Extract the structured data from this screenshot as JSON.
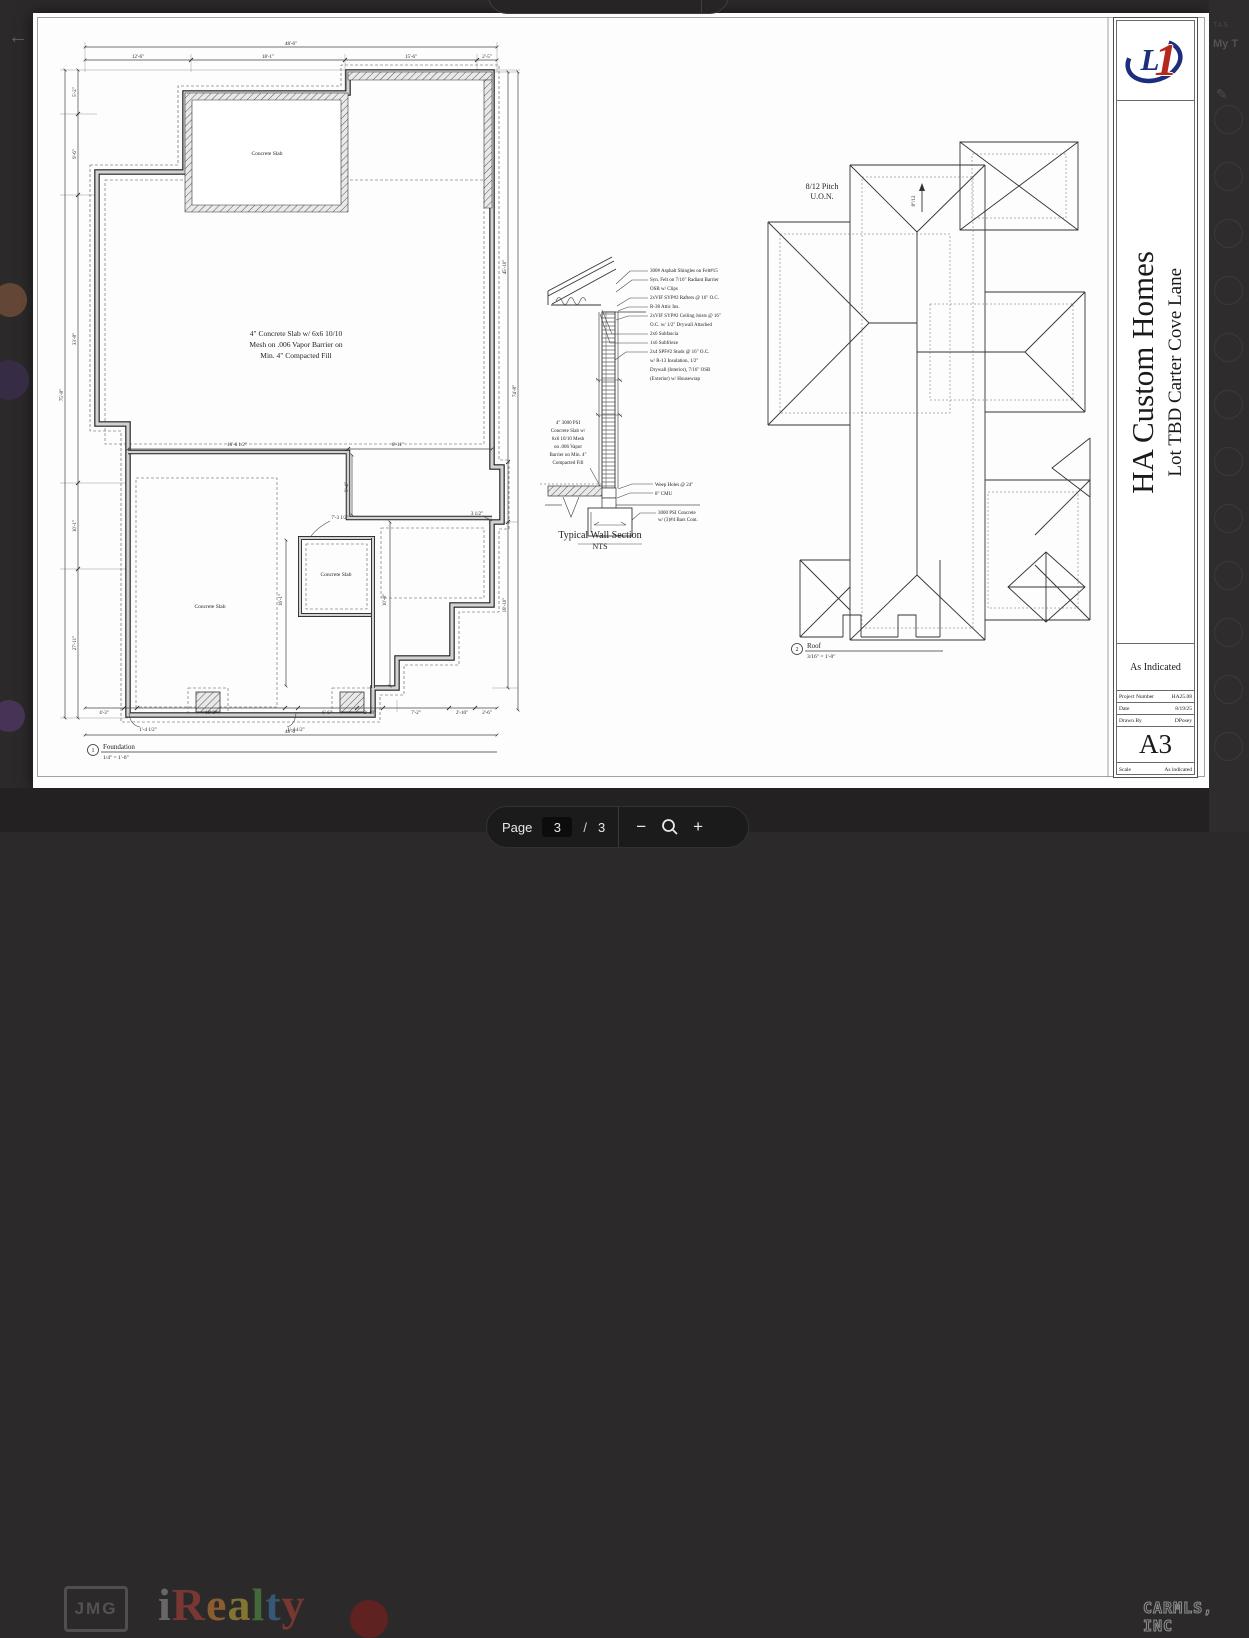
{
  "viewer": {
    "back_icon": "←",
    "bottom_toolbar": {
      "page_label": "Page",
      "current_page": "3",
      "separator": "/",
      "total_pages": "3",
      "zoom_out_icon": "−",
      "zoom_in_icon": "+"
    },
    "right_sidebar": {
      "text_top": "TAS",
      "text_bold": "My T",
      "edit_icon": "✎"
    },
    "background": {
      "jmg_logo": "JMG",
      "irealty_letters": [
        {
          "ch": "i",
          "color": "#9a9a9a"
        },
        {
          "ch": "R",
          "color": "#b8433a"
        },
        {
          "ch": "e",
          "color": "#d98836"
        },
        {
          "ch": "a",
          "color": "#c9b33b"
        },
        {
          "ch": "l",
          "color": "#5a9e4a"
        },
        {
          "ch": "t",
          "color": "#3f7fb5"
        },
        {
          "ch": "y",
          "color": "#b8433a"
        }
      ],
      "watermark": "CARMLS, INC"
    }
  },
  "sheet": {
    "title_block": {
      "logo_l": "L",
      "logo_1": "1",
      "company": "HA Custom Homes",
      "project": "Lot TBD Carter Cove Lane",
      "scale_header": "As Indicated",
      "rows": [
        {
          "label": "Project Number",
          "value": "HA25.08"
        },
        {
          "label": "Date",
          "value": "8/19/25"
        },
        {
          "label": "Drawn By",
          "value": "DPosey"
        }
      ],
      "sheet_number": "A3",
      "scale_label": "Scale",
      "scale_value": "As indicated"
    },
    "foundation": {
      "center_note": [
        "4\" Concrete Slab w/ 6x6 10/10",
        "Mesh on .006 Vapor Barrier on",
        "Min. 4\" Compacted Fill"
      ],
      "slab_labels": [
        "Concrete Slab",
        "Concrete Slab",
        "Concrete Slab"
      ],
      "dims": {
        "top_total": "48'-6\"",
        "top": [
          "12'-6\"",
          "18'-1\"",
          "15'-6\"",
          "2'-5\""
        ],
        "left_total": "75'-8\"",
        "left": [
          "5'-2\"",
          "9'-6\"",
          "33'-8\"",
          "10'-1\"",
          "27'-11\""
        ],
        "right": [
          "45'-10\"",
          "74'-8\"",
          "18'-10\""
        ],
        "bottom": [
          "4'-3\"",
          "16'-3\"",
          "6'-6\"",
          "2'-10\"",
          "7'-2\"",
          "2'-10\"",
          "2'-6\""
        ],
        "bottom_total": "48'-6\"",
        "bottom_leaders": [
          "1'-4 1/2\"",
          "1'-4 1/2\""
        ],
        "mid": [
          "16'-6 1/2\"",
          "8'-11\"",
          "9'-4\"",
          "7'-3 1/2\"",
          "3 1/2\"",
          "16'-1\"",
          "10'-8\""
        ]
      },
      "caption": {
        "num": "1",
        "title": "Foundation",
        "scale": "1/4\" = 1'-0\""
      }
    },
    "wall_section": {
      "notes_right": [
        "300# Asphalt Shingles on Felt#15",
        "Syn. Felt on 7/16\" Radiant Barrier",
        "OSB w/ Clips",
        "2xVIF SYP#2 Rafters @ 16\" O.C.",
        "R-38 Attic Ins.",
        "2xVIF SYP#2 Ceiling Joists @ 16\"",
        "O.C. w/ 1/2\" Drywall Attached",
        "2x6 Subfascia",
        "1x6 Subfrieze",
        "2x4 SPF#2 Studs @ 16\" O.C.",
        "w/ R-13 Insulation, 1/2\"",
        "Drywall (Interior), 7/16\" OSB",
        "(Exterior) w/ Housewrap"
      ],
      "note_left": [
        "4\" 3000 PSI",
        "Concrete Slab w/",
        "6x6 10/10 Mesh",
        "on .006 Vapor",
        "Barrier on Min. 4\"",
        "Compacted Fill"
      ],
      "notes_lower": [
        "Weep Holes @ 24\"",
        "8\" CMU",
        "3000 PSI Concrete",
        "w/ (3)#4 Bars Cont."
      ],
      "caption": {
        "title": "Typical Wall Section",
        "scale": "NTS"
      }
    },
    "roof": {
      "pitch_note": [
        "8/12 Pitch",
        "U.O.N."
      ],
      "slope_label": "8\"/12",
      "caption": {
        "num": "2",
        "title": "Roof",
        "scale": "3/16\" = 1'-0\""
      }
    }
  }
}
